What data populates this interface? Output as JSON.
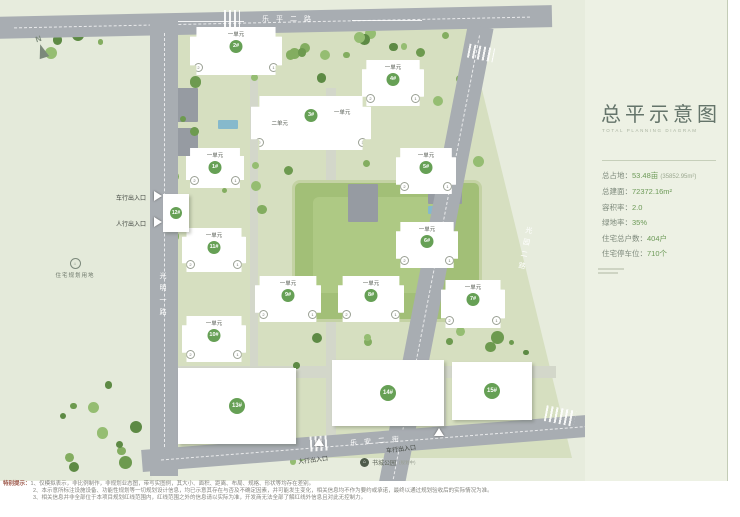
{
  "panel": {
    "title": "总平示意图",
    "subtitle": "TOTAL PLANNING DIAGRAM",
    "stats": [
      {
        "label": "总占地",
        "value": "53.48亩",
        "extra": "(35852.95m²)"
      },
      {
        "label": "总建面",
        "value": "72372.16m²",
        "extra": ""
      },
      {
        "label": "容积率",
        "value": "2.0",
        "extra": ""
      },
      {
        "label": "绿地率",
        "value": "35%",
        "extra": ""
      },
      {
        "label": "住宅总户数",
        "value": "404户",
        "extra": ""
      },
      {
        "label": "住宅停车位",
        "value": "710个",
        "extra": ""
      }
    ]
  },
  "map": {
    "compass_label": "N",
    "roads": {
      "top": "乐平二路",
      "left": "光明一路",
      "right": "光园二路",
      "bottom": "乐安二街"
    },
    "entrances": [
      {
        "label": "车行出入口"
      },
      {
        "label": "人行出入口"
      },
      {
        "label": "人行出入口"
      },
      {
        "label": "车行出入口"
      }
    ],
    "site_labels": {
      "residential_plot": "住宅规划用地",
      "park": "书城公园",
      "park_note": "(规划中)"
    },
    "buildings": [
      {
        "num": "2#",
        "unit": "一单元"
      },
      {
        "num": "4#",
        "unit": "一单元"
      },
      {
        "num": "3#",
        "unit": "二单元",
        "unit2": "一单元"
      },
      {
        "num": "1#",
        "unit": "一单元"
      },
      {
        "num": "5#",
        "unit": "一单元"
      },
      {
        "num": "11#",
        "unit": "一单元"
      },
      {
        "num": "6#",
        "unit": "一单元"
      },
      {
        "num": "12#"
      },
      {
        "num": "9#",
        "unit": "一单元"
      },
      {
        "num": "8#",
        "unit": "一单元"
      },
      {
        "num": "7#",
        "unit": "一单元"
      },
      {
        "num": "10#",
        "unit": "一单元"
      },
      {
        "num": "13#"
      },
      {
        "num": "14#"
      },
      {
        "num": "15#"
      }
    ],
    "unit_dot_labels": [
      "2",
      "1"
    ]
  },
  "footnotes": {
    "prefix": "特别提示：",
    "lines": [
      "1、仅模拟表示，非比例制作，非规划业态图，带写实图例，其大小、面积、距离、布局、规格、形状等均存在差别。",
      "2、本示意所标注设施设备、功能性规划等一切规划设计信息，均已示意其存在与否及不确定因素，并可能发生变化，相关信息均不作为要约或承诺，最终以通过规划验收后的实际情况为准。",
      "3、相关信息并非全部位于本项目规划红线范围内，红线范围之外的信息请以实际为准，开发商无法全部了解红线外信息且对此无控制力。"
    ]
  }
}
